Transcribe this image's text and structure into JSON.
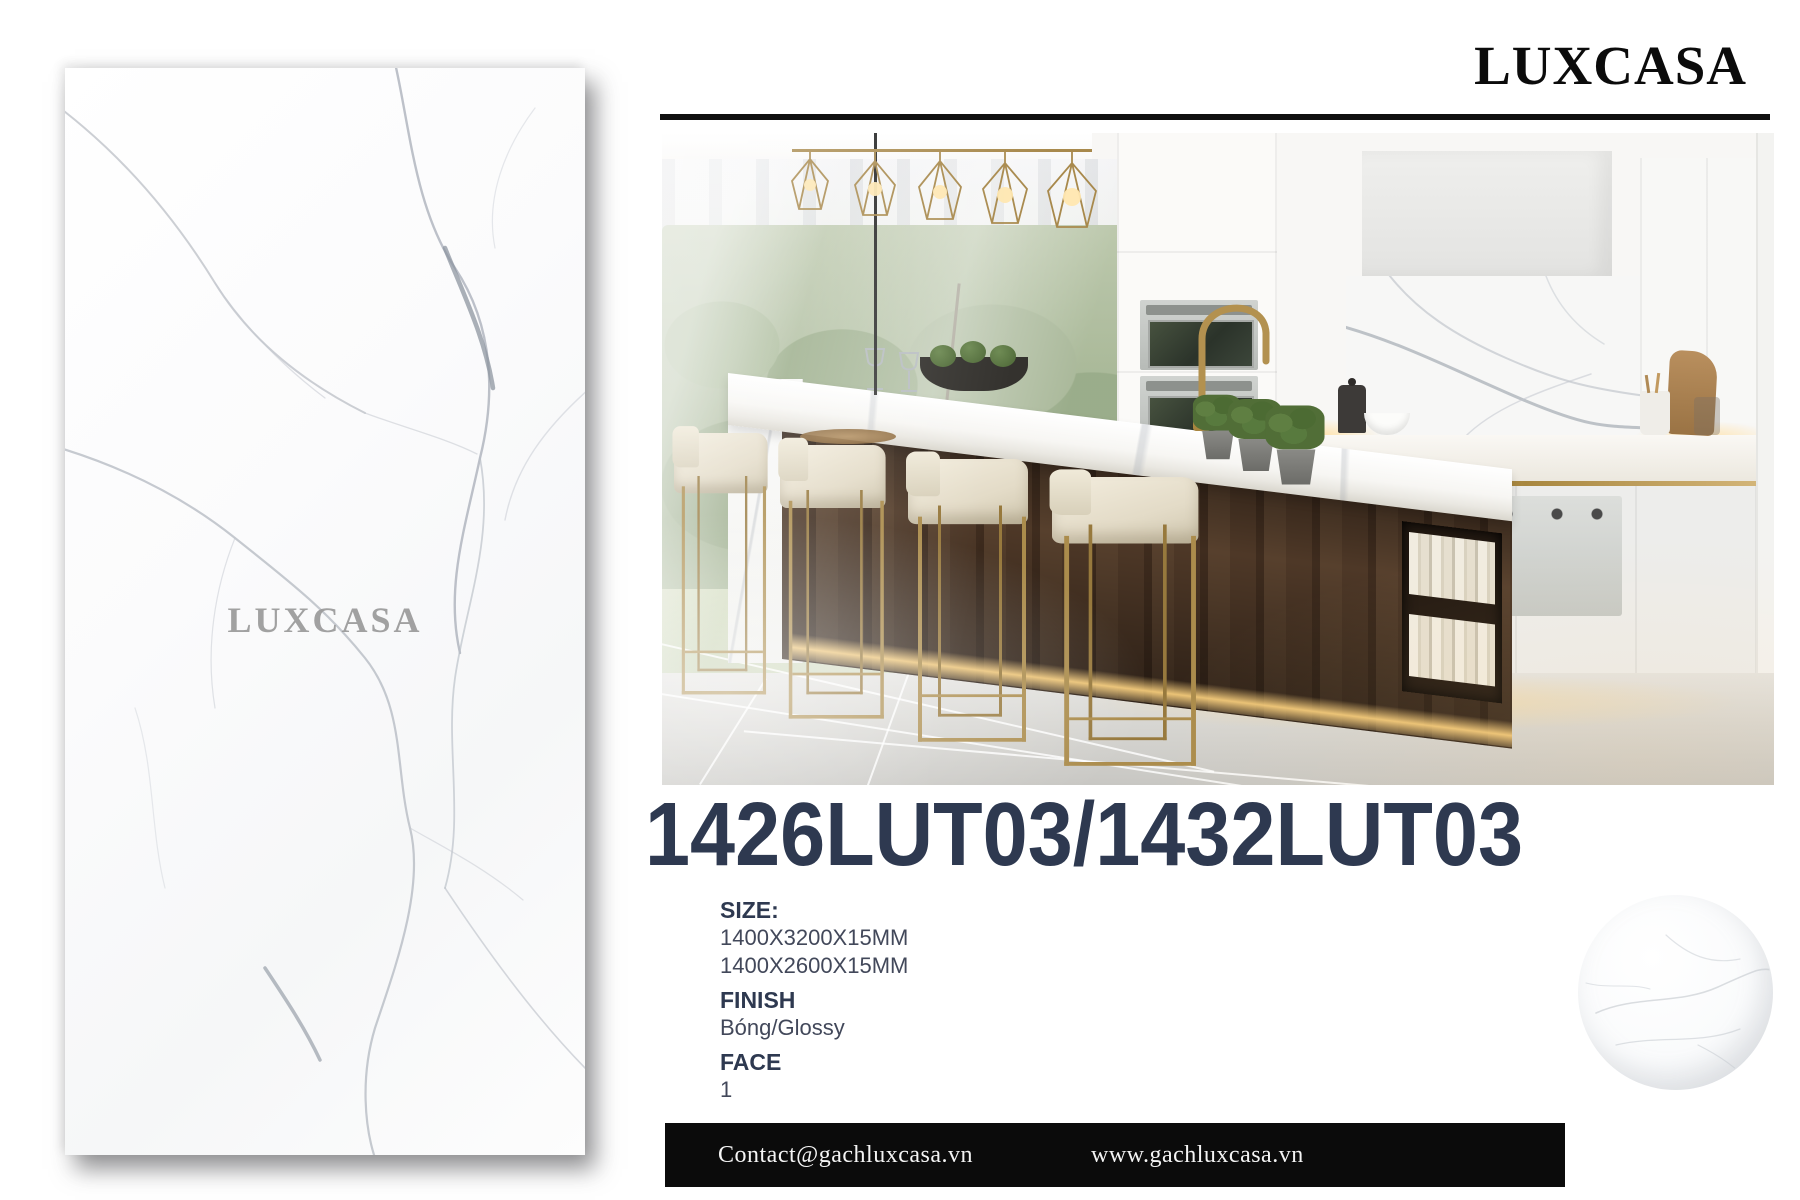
{
  "brand": {
    "logo_lux": "LUX",
    "logo_casa": "CASA",
    "watermark_lux": "LUX",
    "watermark_casa": "CASA"
  },
  "product": {
    "code": "1426LUT03/1432LUT03"
  },
  "specs": {
    "size_label": "SIZE:",
    "sizes": [
      "1400X3200X15MM",
      "1400X2600X15MM"
    ],
    "finish_label": "FINISH",
    "finish_value": "Bóng/Glossy",
    "face_label": "FACE",
    "face_value": "1"
  },
  "footer": {
    "email": "Contact@gachluxcasa.vn",
    "website": "www.gachluxcasa.vn"
  },
  "colors": {
    "accent_navy": "#2e3950",
    "gold": "#ab8c4c",
    "footer_bg": "#0b0b0b",
    "vein_grey": "#b9bec6"
  }
}
